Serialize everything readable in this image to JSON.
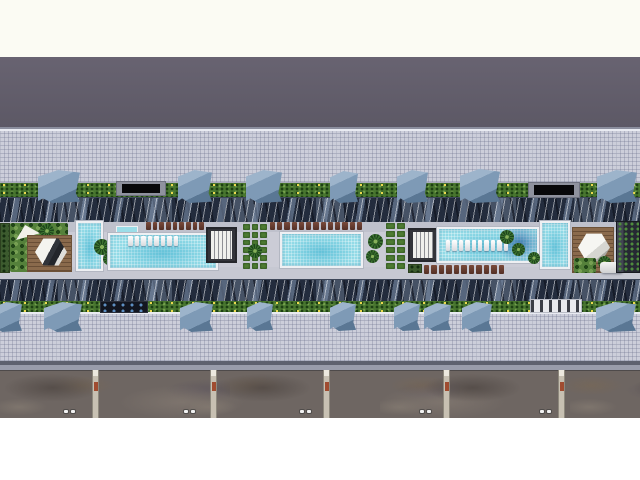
{
  "scene": {
    "canvas": {
      "width": 640,
      "height": 480
    },
    "palette": {
      "white": "#ffffff",
      "cream_margin": "#fbfbf3",
      "roof_plane_gray": "#605c69",
      "plaza_tile": "#ccceda",
      "plaza_line": "#8b8e9e",
      "hedge_green": "#48762f",
      "flower_yellow": "#ecd94f",
      "glass_roof_navy": "#232c3d",
      "glass_roof_steel": "#8098b4",
      "deck_gray": "#cbccd6",
      "walk_gray_dark": "#bfc1cc",
      "walk_gray_light": "#c6c8d2",
      "pool_water": "#93dbe7",
      "pool_deep_blue": "#1e5a94",
      "pool_coping": "#eef0f3",
      "wood_deck": "#8a6a4c",
      "umbrella_white": "#f4f4ef",
      "lounger_brown": "#5d372c",
      "canopy_steel_blue": "#7e9ab6",
      "podium_shadow": "#5e616f",
      "podium_curb": "#999cab",
      "ground_mottled": "#6e6662",
      "divider_concrete": "#c7c0b2",
      "divider_mark_red": "#a04c30"
    },
    "elements": [
      {
        "t": "fill",
        "id": "backdrop",
        "x": 0,
        "y": 0,
        "w": 640,
        "h": 480,
        "c": "#ffffff"
      },
      {
        "t": "fill",
        "id": "top-margin",
        "x": 0,
        "y": 0,
        "w": 640,
        "h": 57,
        "c": "#fbfbf3"
      },
      {
        "t": "roof",
        "id": "upper-roof-plane",
        "x": 0,
        "y": 57,
        "w": 640,
        "h": 72
      },
      {
        "t": "fill",
        "id": "plaza-parapet-line",
        "x": 0,
        "y": 127,
        "w": 640,
        "h": 2,
        "c": "#8b8e9e"
      },
      {
        "t": "plaza",
        "id": "upper-plaza-terrace",
        "x": 0,
        "y": 129,
        "w": 640,
        "h": 54
      },
      {
        "t": "hedge",
        "id": "upper-hedge-flowers",
        "x": 0,
        "y": 183,
        "w": 640,
        "h": 16
      },
      {
        "t": "glass",
        "id": "upper-glass-roof-band",
        "x": 0,
        "y": 197,
        "w": 640,
        "h": 26
      },
      {
        "t": "fill",
        "id": "deck-base",
        "x": 0,
        "y": 222,
        "w": 640,
        "h": 57,
        "c": "#cbccd6"
      },
      {
        "t": "walk",
        "id": "deck-upper-walkway",
        "x": 0,
        "y": 222,
        "w": 640,
        "h": 10,
        "c": "#bfc1cc"
      },
      {
        "t": "walk",
        "id": "deck-lower-walkway",
        "x": 0,
        "y": 267,
        "w": 640,
        "h": 12,
        "c": "#c6c8d2"
      },
      {
        "t": "glass",
        "id": "lower-glass-roof-band",
        "x": 0,
        "y": 279,
        "w": 640,
        "h": 24
      },
      {
        "t": "hedge",
        "id": "lower-hedge-flowers",
        "x": 0,
        "y": 301,
        "w": 640,
        "h": 12
      },
      {
        "t": "plaza",
        "id": "lower-plaza-terrace",
        "x": 0,
        "y": 312,
        "w": 640,
        "h": 50
      },
      {
        "t": "fill",
        "id": "podium-edge-shadow",
        "x": 0,
        "y": 361,
        "w": 640,
        "h": 4,
        "c": "#5e616f"
      },
      {
        "t": "fill",
        "id": "podium-edge-curb",
        "x": 0,
        "y": 365,
        "w": 640,
        "h": 5,
        "c": "#999cab"
      },
      {
        "t": "ground",
        "id": "ground-plots-strip",
        "x": 0,
        "y": 370,
        "w": 640,
        "h": 48
      },
      {
        "t": "fill",
        "id": "bottom-margin",
        "x": 0,
        "y": 418,
        "w": 640,
        "h": 62,
        "c": "#ffffff"
      },
      {
        "t": "gdiv",
        "id": "plot-divider-1",
        "x": 92,
        "y": 370,
        "w": 7,
        "h": 48
      },
      {
        "t": "gdiv",
        "id": "plot-divider-2",
        "x": 210,
        "y": 370,
        "w": 7,
        "h": 48
      },
      {
        "t": "gdiv",
        "id": "plot-divider-3",
        "x": 323,
        "y": 370,
        "w": 7,
        "h": 48
      },
      {
        "t": "gdiv",
        "id": "plot-divider-4",
        "x": 443,
        "y": 370,
        "w": 7,
        "h": 48
      },
      {
        "t": "gdiv",
        "id": "plot-divider-5",
        "x": 558,
        "y": 370,
        "w": 7,
        "h": 48
      },
      {
        "t": "cars",
        "id": "parked-dots-1",
        "x": 64,
        "y": 410,
        "w": 12,
        "h": 4
      },
      {
        "t": "cars",
        "id": "parked-dots-2",
        "x": 184,
        "y": 410,
        "w": 12,
        "h": 4
      },
      {
        "t": "cars",
        "id": "parked-dots-3",
        "x": 300,
        "y": 410,
        "w": 12,
        "h": 4
      },
      {
        "t": "cars",
        "id": "parked-dots-4",
        "x": 420,
        "y": 410,
        "w": 12,
        "h": 4
      },
      {
        "t": "cars",
        "id": "parked-dots-5",
        "x": 540,
        "y": 410,
        "w": 12,
        "h": 4
      },
      {
        "t": "canopy",
        "id": "roof-canopy-top-1",
        "x": 38,
        "y": 170,
        "w": 42,
        "h": 33
      },
      {
        "t": "slab",
        "id": "dark-canopy-top-1",
        "x": 116,
        "y": 181,
        "w": 50,
        "h": 15
      },
      {
        "t": "canopy",
        "id": "roof-canopy-top-2",
        "x": 178,
        "y": 170,
        "w": 34,
        "h": 33
      },
      {
        "t": "canopy",
        "id": "roof-canopy-top-3",
        "x": 246,
        "y": 170,
        "w": 36,
        "h": 33
      },
      {
        "t": "canopy",
        "id": "roof-canopy-top-4",
        "x": 330,
        "y": 171,
        "w": 28,
        "h": 32
      },
      {
        "t": "canopy",
        "id": "roof-canopy-top-5",
        "x": 397,
        "y": 170,
        "w": 31,
        "h": 33
      },
      {
        "t": "canopy",
        "id": "roof-canopy-top-6",
        "x": 460,
        "y": 169,
        "w": 40,
        "h": 34
      },
      {
        "t": "slab",
        "id": "dark-canopy-top-2",
        "x": 528,
        "y": 182,
        "w": 52,
        "h": 16
      },
      {
        "t": "canopy",
        "id": "roof-canopy-top-7",
        "x": 597,
        "y": 170,
        "w": 40,
        "h": 33
      },
      {
        "t": "canopy",
        "id": "roof-canopy-bottom-1",
        "x": -8,
        "y": 302,
        "w": 30,
        "h": 30
      },
      {
        "t": "canopy",
        "id": "roof-canopy-bottom-2",
        "x": 44,
        "y": 302,
        "w": 38,
        "h": 30
      },
      {
        "t": "shadestrip",
        "id": "dark-walk-canopy",
        "x": 100,
        "y": 301,
        "w": 48,
        "h": 12
      },
      {
        "t": "canopy",
        "id": "roof-canopy-bottom-3",
        "x": 180,
        "y": 302,
        "w": 33,
        "h": 30
      },
      {
        "t": "canopy",
        "id": "roof-canopy-bottom-4",
        "x": 247,
        "y": 302,
        "w": 26,
        "h": 29
      },
      {
        "t": "canopy",
        "id": "roof-canopy-bottom-5",
        "x": 330,
        "y": 302,
        "w": 26,
        "h": 29
      },
      {
        "t": "canopy",
        "id": "roof-canopy-bottom-6",
        "x": 394,
        "y": 302,
        "w": 26,
        "h": 29
      },
      {
        "t": "canopy",
        "id": "roof-canopy-bottom-7",
        "x": 424,
        "y": 303,
        "w": 27,
        "h": 28
      },
      {
        "t": "canopy",
        "id": "roof-canopy-bottom-8",
        "x": 462,
        "y": 302,
        "w": 30,
        "h": 30
      },
      {
        "t": "lpav",
        "id": "lower-pavilion-roof",
        "x": 530,
        "y": 299,
        "w": 52,
        "h": 14
      },
      {
        "t": "canopy",
        "id": "roof-canopy-bottom-9",
        "x": 596,
        "y": 302,
        "w": 40,
        "h": 30
      },
      {
        "t": "pbox",
        "id": "left-edge-planter",
        "x": 0,
        "y": 223,
        "w": 10,
        "h": 50
      },
      {
        "t": "lawn",
        "id": "left-garden-lawn",
        "x": 10,
        "y": 223,
        "w": 58,
        "h": 49
      },
      {
        "t": "sail",
        "id": "shade-sail",
        "x": 16,
        "y": 225,
        "w": 24,
        "h": 15
      },
      {
        "t": "palm",
        "id": "garden-palm-1",
        "x": 40,
        "y": 224,
        "w": 14,
        "h": 14
      },
      {
        "t": "wood",
        "id": "left-cabana-deck",
        "x": 27,
        "y": 235,
        "w": 45,
        "h": 37
      },
      {
        "t": "hex",
        "id": "cabana-umbrella-left",
        "x": 35,
        "y": 238,
        "w": 32,
        "h": 28
      },
      {
        "t": "pool",
        "id": "plunge-pool-west",
        "x": 76,
        "y": 221,
        "w": 27,
        "h": 50
      },
      {
        "t": "palm",
        "id": "garden-palm-2",
        "x": 94,
        "y": 239,
        "w": 16,
        "h": 16
      },
      {
        "t": "palm",
        "id": "garden-palm-3",
        "x": 103,
        "y": 253,
        "w": 12,
        "h": 12
      },
      {
        "t": "poolext",
        "id": "lap-pool-west-step",
        "x": 116,
        "y": 226,
        "w": 22,
        "h": 10
      },
      {
        "t": "pool",
        "id": "lap-pool-west",
        "x": 108,
        "y": 233,
        "w": 110,
        "h": 37
      },
      {
        "t": "wrow",
        "id": "in-pool-loungers-west",
        "x": 128,
        "y": 236,
        "w": 50,
        "h": 10,
        "k": 8
      },
      {
        "t": "lrow",
        "id": "sun-loungers-west",
        "x": 146,
        "y": 222,
        "w": 58,
        "h": 8,
        "k": 9
      },
      {
        "t": "pavilion",
        "id": "pool-pavilion-west",
        "x": 206,
        "y": 227,
        "w": 31,
        "h": 36
      },
      {
        "t": "grid",
        "id": "planter-grid-west",
        "x": 242,
        "y": 223,
        "w": 26,
        "h": 47,
        "cols": 3,
        "k": 18
      },
      {
        "t": "palm",
        "id": "planter-palm-west",
        "x": 248,
        "y": 244,
        "w": 14,
        "h": 14
      },
      {
        "t": "lrow",
        "id": "sun-loungers-center",
        "x": 270,
        "y": 222,
        "w": 92,
        "h": 8,
        "k": 13
      },
      {
        "t": "pool",
        "id": "center-pool",
        "x": 280,
        "y": 232,
        "w": 83,
        "h": 36
      },
      {
        "t": "palm",
        "id": "center-palm-1",
        "x": 368,
        "y": 234,
        "w": 15,
        "h": 15
      },
      {
        "t": "palm",
        "id": "center-palm-2",
        "x": 366,
        "y": 250,
        "w": 13,
        "h": 13
      },
      {
        "t": "grid",
        "id": "planter-grid-center",
        "x": 385,
        "y": 222,
        "w": 21,
        "h": 48,
        "cols": 2,
        "k": 12
      },
      {
        "t": "pavilion",
        "id": "pool-pavilion-east",
        "x": 408,
        "y": 228,
        "w": 30,
        "h": 34
      },
      {
        "t": "pool",
        "id": "lap-pool-east",
        "x": 437,
        "y": 227,
        "w": 102,
        "h": 36,
        "shade": true
      },
      {
        "t": "wrow",
        "id": "in-pool-loungers-east",
        "x": 446,
        "y": 240,
        "w": 62,
        "h": 11,
        "k": 10
      },
      {
        "t": "palm",
        "id": "east-palm-1",
        "x": 500,
        "y": 230,
        "w": 14,
        "h": 14
      },
      {
        "t": "palm",
        "id": "east-palm-2",
        "x": 512,
        "y": 243,
        "w": 13,
        "h": 13
      },
      {
        "t": "pbox",
        "id": "east-planter",
        "x": 408,
        "y": 264,
        "w": 14,
        "h": 9
      },
      {
        "t": "lrow",
        "id": "sun-loungers-east",
        "x": 424,
        "y": 265,
        "w": 80,
        "h": 9,
        "k": 11
      },
      {
        "t": "pool",
        "id": "plunge-pool-east",
        "x": 540,
        "y": 221,
        "w": 30,
        "h": 48
      },
      {
        "t": "palm",
        "id": "east-palm-3",
        "x": 528,
        "y": 252,
        "w": 12,
        "h": 12
      },
      {
        "t": "wood",
        "id": "right-cabana-deck",
        "x": 572,
        "y": 227,
        "w": 42,
        "h": 46
      },
      {
        "t": "hex",
        "id": "cabana-umbrella-right",
        "x": 578,
        "y": 233,
        "w": 32,
        "h": 29,
        "v": 2
      },
      {
        "t": "lawn",
        "id": "right-garden-plants",
        "x": 574,
        "y": 258,
        "w": 22,
        "h": 15
      },
      {
        "t": "palm",
        "id": "right-garden-palm",
        "x": 598,
        "y": 256,
        "w": 13,
        "h": 13
      },
      {
        "t": "sofa",
        "id": "outdoor-sofa",
        "x": 600,
        "y": 262,
        "w": 22,
        "h": 11
      },
      {
        "t": "bldg",
        "id": "green-roof-structure",
        "x": 616,
        "y": 221,
        "w": 24,
        "h": 52
      }
    ]
  }
}
